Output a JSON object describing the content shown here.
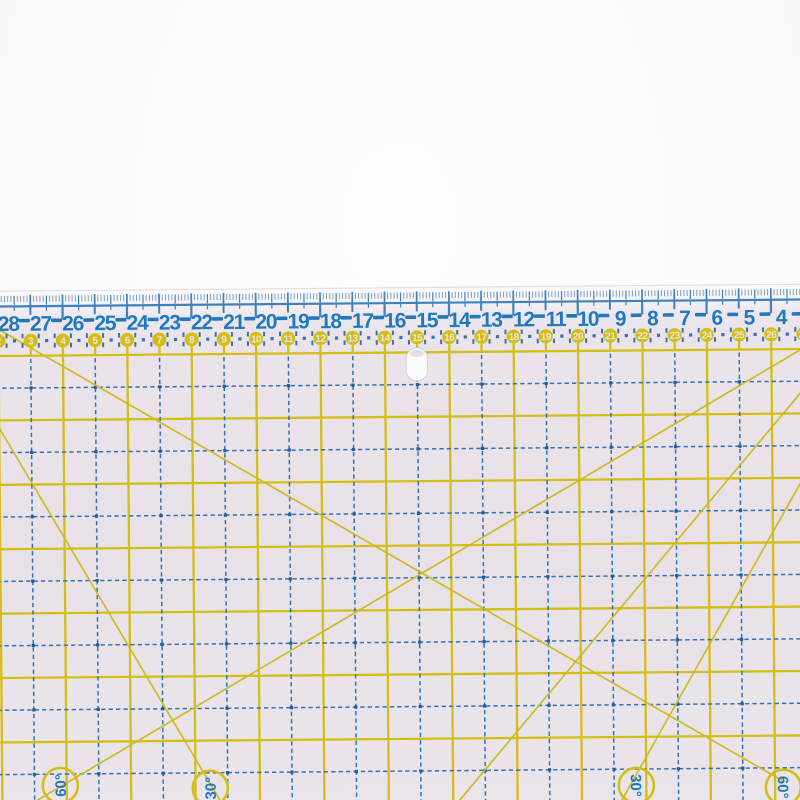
{
  "photo": {
    "background_color": "#fbfbfb"
  },
  "ruler": {
    "blue_scale_numbers": [
      28,
      27,
      26,
      25,
      24,
      23,
      22,
      21,
      20,
      19,
      18,
      17,
      16,
      15,
      14,
      13,
      12,
      11,
      10,
      9,
      8,
      7,
      6,
      5,
      4
    ],
    "yellow_scale_numbers": [
      2,
      3,
      4,
      5,
      6,
      7,
      8,
      9,
      10,
      11,
      12,
      13,
      14,
      15,
      16,
      17,
      18,
      19,
      20,
      21,
      22,
      23,
      24,
      25,
      26,
      27
    ],
    "angle_labels": [
      {
        "text": "60°",
        "cx": 56,
        "cy": 786,
        "rotation": -90
      },
      {
        "text": "30°",
        "cx": 206,
        "cy": 790,
        "rotation": -90
      },
      {
        "text": "30°",
        "cx": 632,
        "cy": 791,
        "rotation": 90
      },
      {
        "text": "60°",
        "cx": 779,
        "cy": 794,
        "rotation": 90
      }
    ],
    "diagonal_lines": [
      {
        "x1": -4,
        "y1": 328,
        "x2": 779,
        "y2": 788
      },
      {
        "x1": 20,
        "y1": 808,
        "x2": 808,
        "y2": 352
      },
      {
        "x1": -6,
        "y1": 421,
        "x2": 219,
        "y2": 808
      },
      {
        "x1": 616,
        "y1": 808,
        "x2": 808,
        "y2": 474
      },
      {
        "x1": 452,
        "y1": 808,
        "x2": 808,
        "y2": 390
      }
    ],
    "colors": {
      "body": "#eae4ea",
      "body_gradient_top": "#fbfafa",
      "edge_highlight": "#dcdadc",
      "tick_blue": "#3f81bc",
      "tick_blue_light": "#6b9ac9",
      "number_blue": "#1f79bd",
      "dash_blue": "#3672b1",
      "dot_blue": "#1d5f9e",
      "grid_yellow": "#d2be14",
      "diagonal_yellow": "#cdb91b",
      "circle_yellow": "#d2be14",
      "circle_text": "#e9e3e9",
      "hole_fill": "#fbfbfb",
      "hole_rim": "#d5d0d5"
    }
  }
}
